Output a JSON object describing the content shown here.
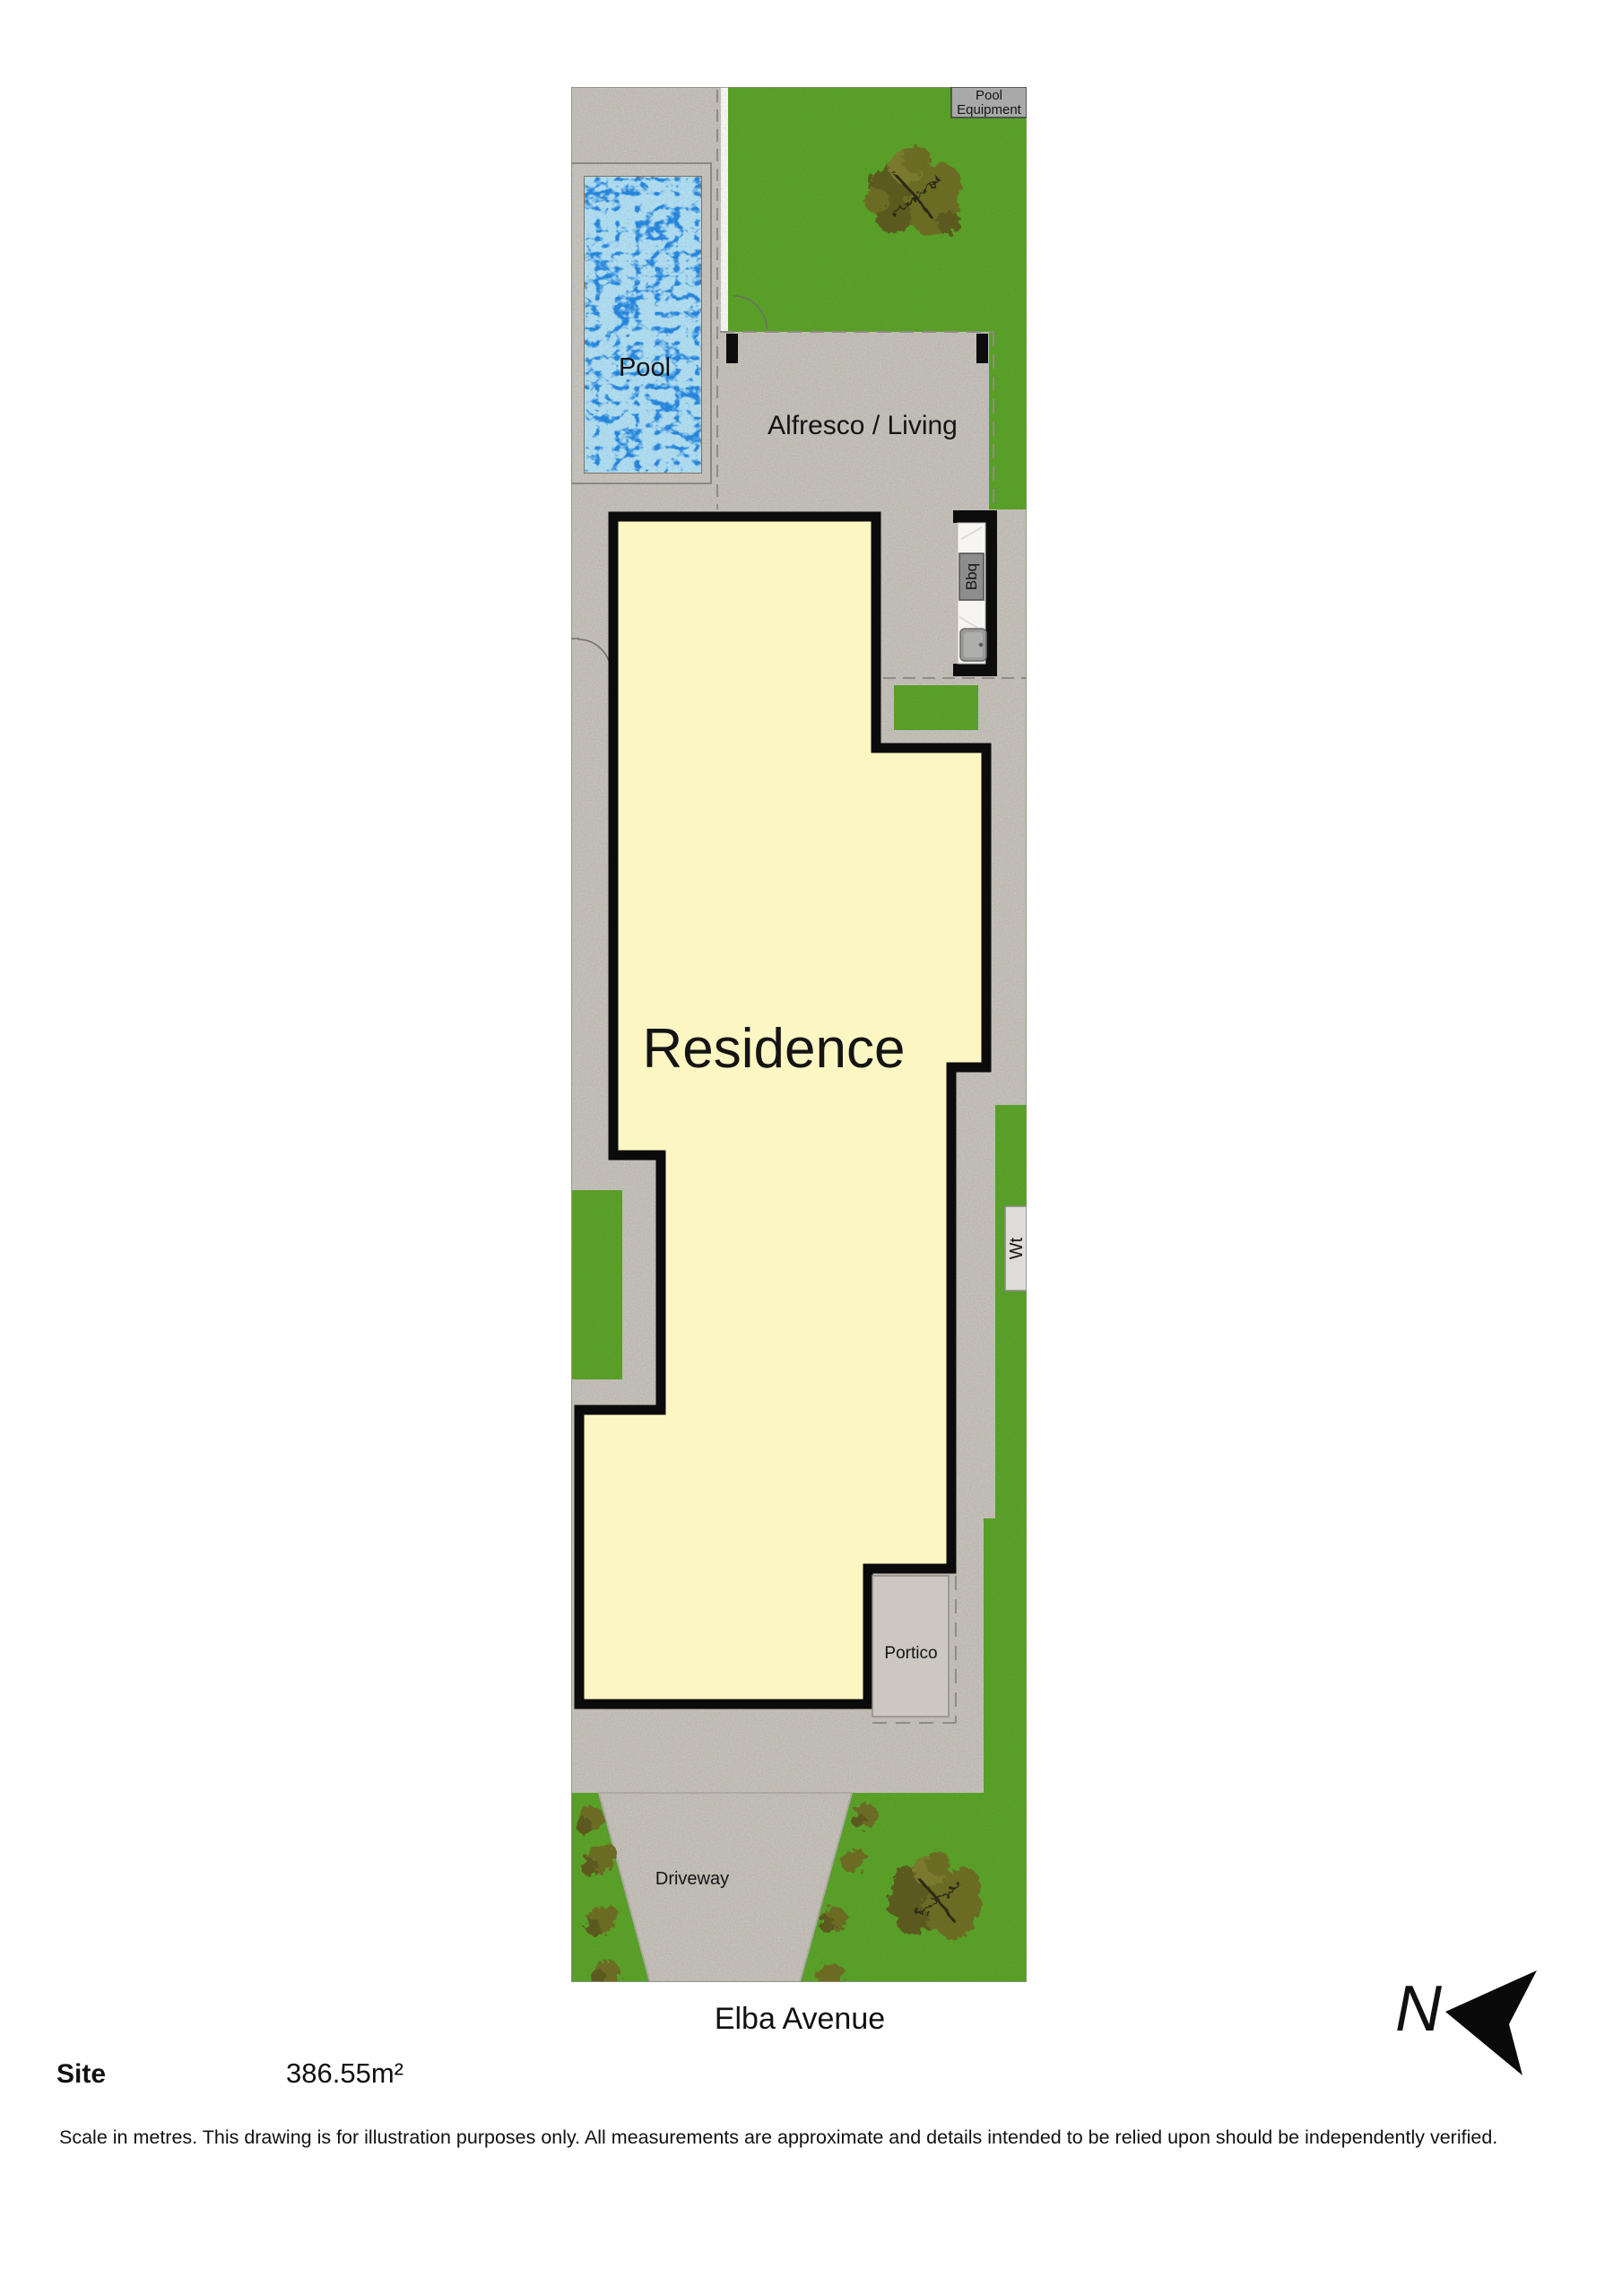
{
  "plan": {
    "labels": {
      "pool": "Pool",
      "pool_equipment_line1": "Pool",
      "pool_equipment_line2": "Equipment",
      "alfresco": "Alfresco / Living",
      "bbq": "Bbq",
      "residence": "Residence",
      "water_tank": "Wt",
      "portico": "Portico",
      "driveway": "Driveway"
    },
    "street_name": "Elba Avenue"
  },
  "site_info": {
    "label": "Site",
    "area": "386.55m²"
  },
  "compass": {
    "north_label": "N"
  },
  "disclaimer": "Scale in metres. This drawing is for illustration purposes only. All measurements are approximate and details intended to be relied upon should be independently verified.",
  "colors": {
    "paving": "#c8c4bd",
    "grass": "#55a320",
    "pool_water": "#1c86e8",
    "residence_fill": "#fcf6c3",
    "outline_black": "#0b0b0b",
    "tree_olive": "#6b6a1d",
    "equipment_box": "#a9a9a9",
    "counter_marble": "#f6f5f2"
  }
}
